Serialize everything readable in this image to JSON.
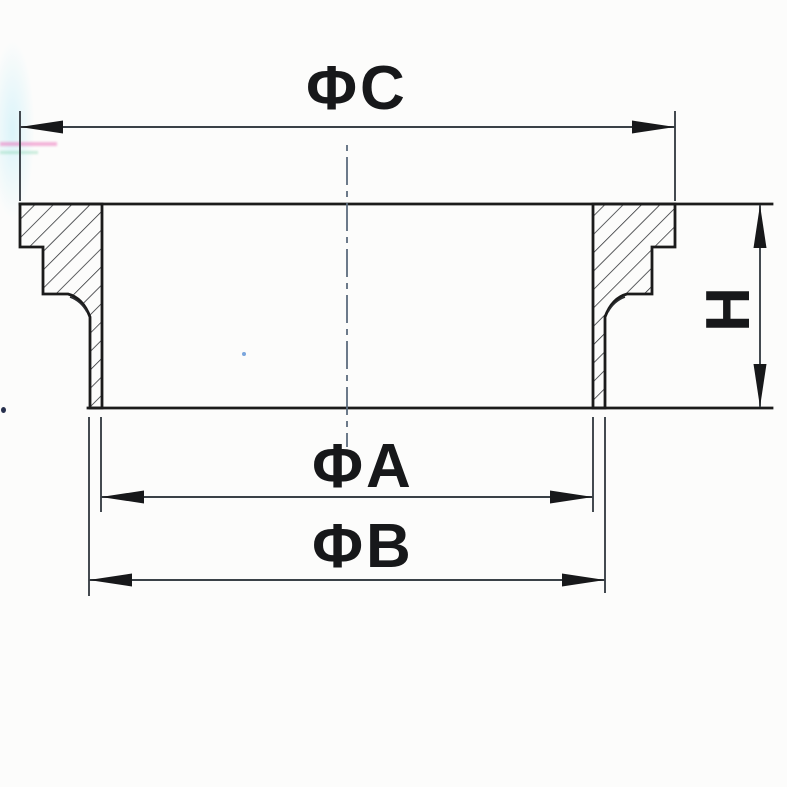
{
  "drawing": {
    "type": "section-view-technical-drawing",
    "dimensions": {
      "top_diameter": {
        "label": "ΦC",
        "orientation": "horizontal"
      },
      "inner_diameter": {
        "label": "ΦA",
        "orientation": "horizontal"
      },
      "outer_diameter": {
        "label": "ΦB",
        "orientation": "horizontal"
      },
      "height": {
        "label": "H",
        "orientation": "vertical"
      }
    },
    "colors": {
      "paper": "#fcfcfb",
      "ink": "#1b1b1b",
      "dim_line": "#3a4147",
      "centerline": "#5c6c7d",
      "hatch": "#26282b",
      "text": "#17181a"
    }
  }
}
